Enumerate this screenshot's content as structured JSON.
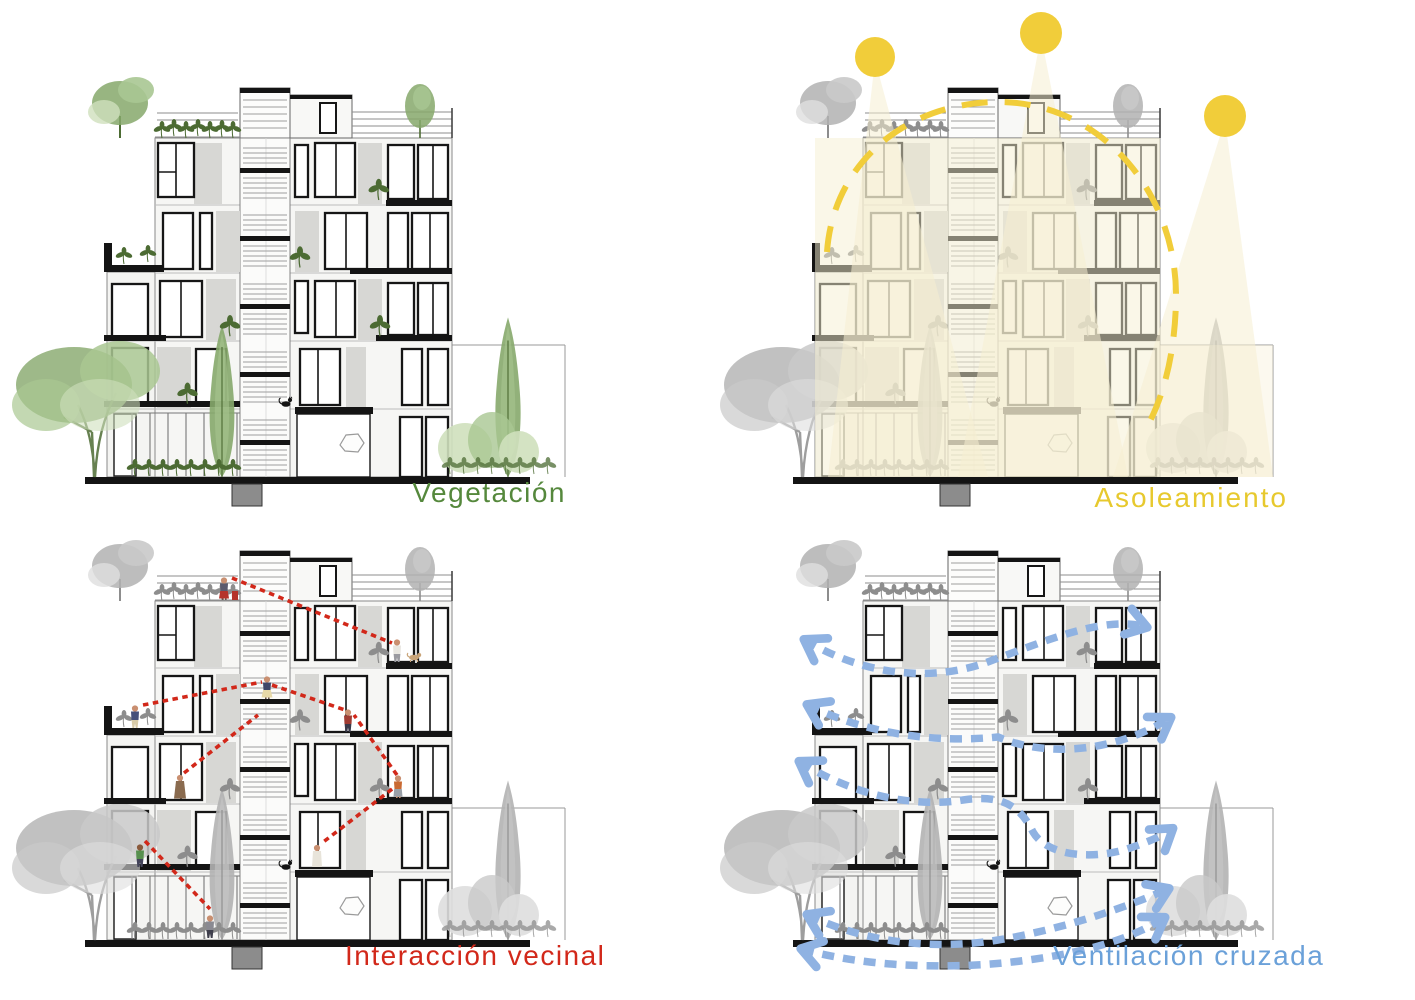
{
  "page": {
    "background": "#ffffff",
    "layout": "2x2 grid of building section diagrams"
  },
  "panels": [
    {
      "id": "vegetacion",
      "caption": "Vegetación",
      "accent": "green",
      "overlay": "vegetation"
    },
    {
      "id": "asoleamiento",
      "caption": "Asoleamiento",
      "accent": "yellow",
      "overlay": "sun-path",
      "suns": 3
    },
    {
      "id": "interaccion-vecinal",
      "caption": "Interacción vecinal",
      "accent": "red",
      "overlay": "neighbor-interaction",
      "people": 10
    },
    {
      "id": "ventilacion-cruzada",
      "caption": "Ventilación cruzada",
      "accent": "blue",
      "overlay": "cross-ventilation",
      "wind_arrows": 5
    }
  ],
  "theme": {
    "colors": {
      "green": "#55883c",
      "yellow": "#e7c92e",
      "red": "#d2281a",
      "blue": "#6ba1d9",
      "blueArrow": "#8fb2e2",
      "sun": "#f1cd3a",
      "paleSun": "#f6efd2"
    }
  }
}
